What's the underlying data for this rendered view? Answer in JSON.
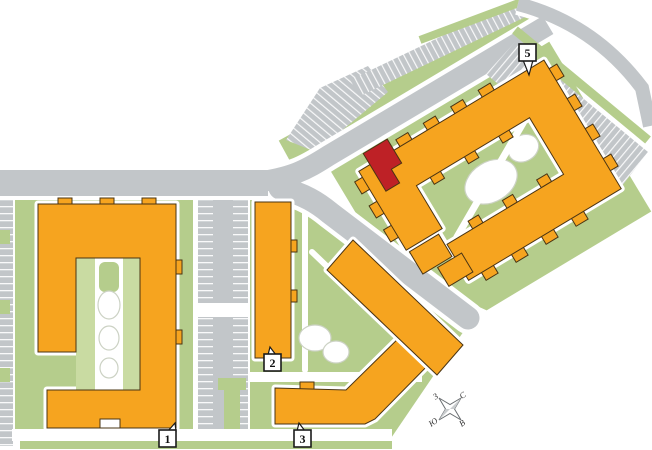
{
  "buildings": {
    "b1": {
      "label": "1"
    },
    "b2": {
      "label": "2"
    },
    "b3": {
      "label": "3"
    },
    "b5": {
      "label": "5"
    }
  },
  "selected_unit": {
    "building": "5",
    "color": "#be2126"
  },
  "compass": {
    "north": "С",
    "south": "Ю",
    "west": "З",
    "east": "В"
  },
  "colors": {
    "building": "#f6a41f",
    "outline": "#4a3413",
    "highlight": "#be2126",
    "green": "#b5cd8c",
    "green_light": "#c9dba2",
    "road": "#c2c6c9",
    "pond_outline": "#ccd2c4",
    "label_bg": "#ffffff",
    "label_border": "#1a1a1a",
    "compass_outline": "#6b6f72"
  }
}
